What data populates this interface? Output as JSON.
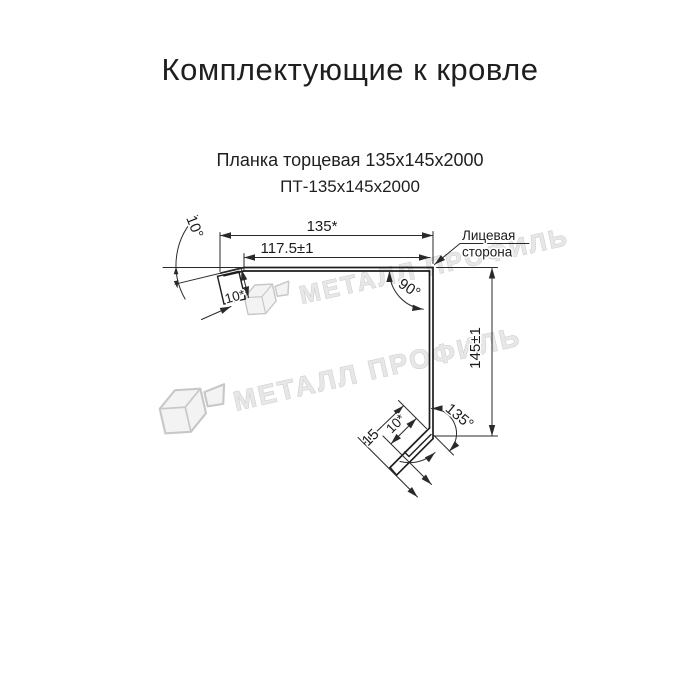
{
  "title": "Комплектующие к кровле",
  "product": {
    "name": "Планка торцевая 135х145х2000",
    "code": "ПТ-135х145х2000"
  },
  "drawing": {
    "dimensions": {
      "total_width": "135*",
      "flat_width": "117.5±1",
      "height": "145±1",
      "bottom_flange": "15",
      "left_hem": "10*",
      "bottom_hem": "10*"
    },
    "angles": {
      "top_left": "10°",
      "corner": "90°",
      "bottom": "135°"
    },
    "face_label": {
      "line1": "Лицевая",
      "line2": "сторона"
    },
    "line_color": "#1d1d1d"
  },
  "watermark": {
    "text": "МЕТАЛЛ ПРОФИЛЬ",
    "color": "#e7e7e7"
  }
}
